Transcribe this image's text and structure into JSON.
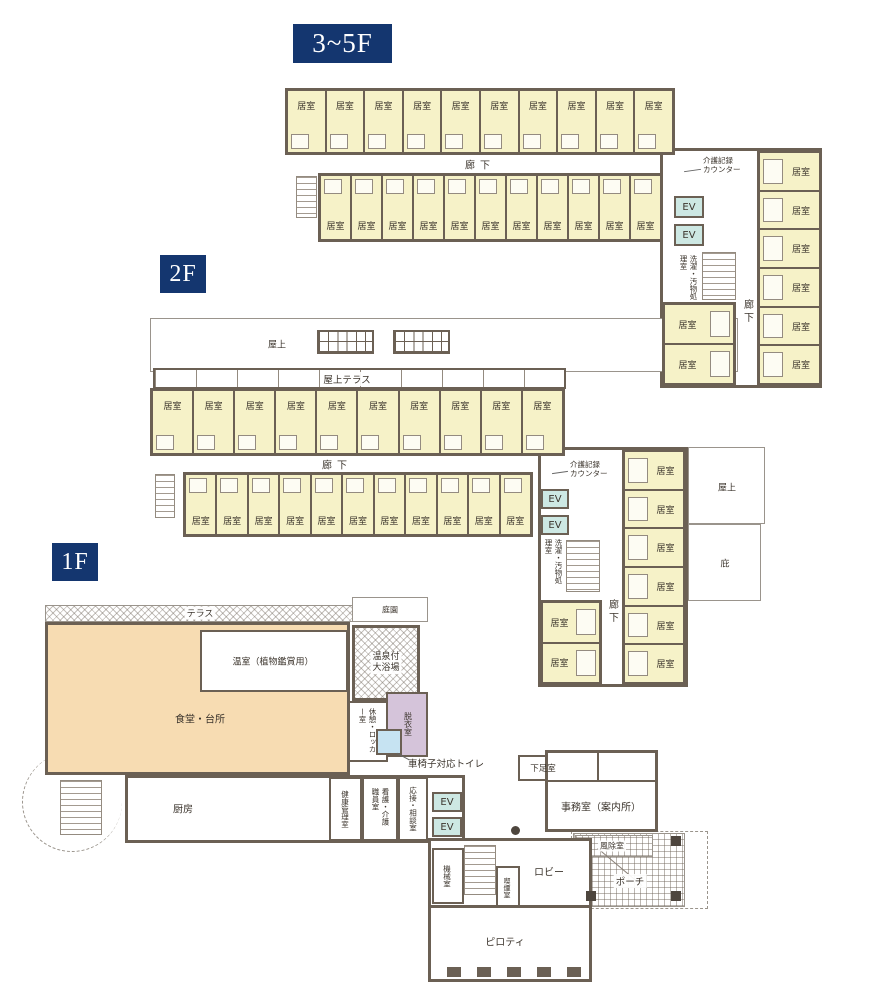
{
  "colors": {
    "wall": "#6b6054",
    "wall-light": "#948b80",
    "room": "#f6f2c8",
    "dining": "#f7dcb2",
    "ev": "#cde8e3",
    "dressing": "#d5c4da",
    "toilet": "#c6e3f2",
    "navy": "#14366f",
    "outline": "#9a948c"
  },
  "floors": {
    "f35": {
      "label": "3~5F",
      "corridor_label": "廊下",
      "upper_rooms": [
        "居室",
        "居室",
        "居室",
        "居室",
        "居室",
        "居室",
        "居室",
        "居室",
        "居室",
        "居室"
      ],
      "lower_rooms": [
        "居室",
        "居室",
        "居室",
        "居室",
        "居室",
        "居室",
        "居室",
        "居室",
        "居室",
        "居室",
        "居室"
      ],
      "wing": {
        "counter_label": "介護記録\nカウンター",
        "ev_labels": [
          "EV",
          "EV"
        ],
        "laundry_label": "洗濯・汚物処理室",
        "corridor_label": "廊下",
        "left_rooms": [
          "居室",
          "居室"
        ],
        "right_rooms": [
          "居室",
          "居室",
          "居室",
          "居室",
          "居室",
          "居室"
        ]
      }
    },
    "f2": {
      "label": "2F",
      "roof_label": "屋上",
      "roof_terrace_label": "屋上テラス",
      "corridor_label": "廊下",
      "upper_rooms": [
        "居室",
        "居室",
        "居室",
        "居室",
        "居室",
        "居室",
        "居室",
        "居室",
        "居室",
        "居室"
      ],
      "lower_rooms": [
        "居室",
        "居室",
        "居室",
        "居室",
        "居室",
        "居室",
        "居室",
        "居室",
        "居室",
        "居室",
        "居室"
      ],
      "wing": {
        "counter_label": "介護記録\nカウンター",
        "ev_labels": [
          "EV",
          "EV"
        ],
        "laundry_label": "洗濯・汚物処理室",
        "corridor_label": "廊下",
        "left_rooms": [
          "居室",
          "居室"
        ],
        "right_rooms": [
          "居室",
          "居室",
          "居室",
          "居室",
          "居室",
          "居室"
        ],
        "roof_label": "屋上",
        "eaves_label": "庇"
      }
    },
    "f1": {
      "label": "1F",
      "rooms": {
        "terrace": "テラス",
        "garden": "庭園",
        "greenhouse": "温室（植物鑑賞用）",
        "dining": "食堂・台所",
        "bath": "温泉付\n大浴場",
        "locker": "休憩・ロッカー室",
        "dressing": "脱衣室",
        "wheelchair_toilet": "車椅子対応トイレ",
        "kitchen": "厨房",
        "health": "健康管理室",
        "staff": "看護・介護職員室",
        "consult": "応接・相談室",
        "ev_labels": [
          "EV",
          "EV"
        ],
        "shoe": "下足室",
        "office": "事務室（案内所）",
        "windbreak": "風除室",
        "porch": "ポーチ",
        "lobby": "ロビー",
        "machine": "機械室",
        "smoking": "喫煙室",
        "piloti": "ピロティ"
      }
    }
  }
}
